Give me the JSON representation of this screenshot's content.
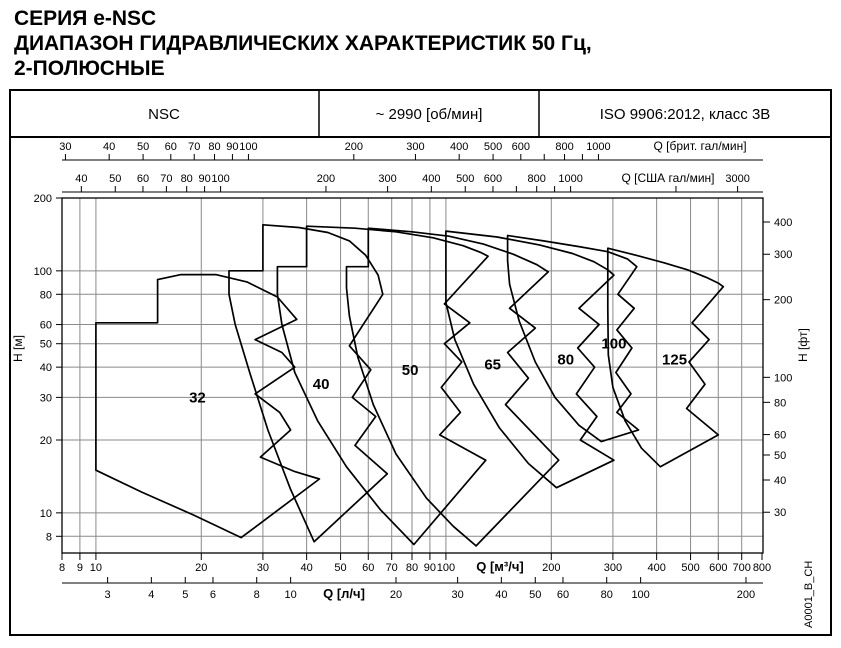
{
  "title": {
    "line1": "СЕРИЯ e-NSC",
    "line2": "ДИАПАЗОН ГИДРАВЛИЧЕСКИХ ХАРАКТЕРИСТИК 50 Гц,",
    "line3": "2-ПОЛЮСНЫЕ"
  },
  "header": {
    "series": "NSC",
    "speed": "~ 2990 [об/мин]",
    "standard": "ISO 9906:2012, класс 3В"
  },
  "side_code": "A0001_B_CH",
  "chart_data": {
    "type": "area",
    "scale": "log-log",
    "x_range_m3h": [
      8,
      800
    ],
    "y_range_m": [
      6.8,
      200
    ],
    "axes": {
      "imp": {
        "label": "Q [брит. гал/мин]",
        "to_m3h": 0.27276,
        "ticks": [
          30,
          40,
          50,
          60,
          70,
          80,
          90,
          100,
          200,
          300,
          400,
          500,
          600,
          700,
          800,
          900,
          1000
        ],
        "unlabeled": [
          700,
          900
        ]
      },
      "us": {
        "label": "Q [США гал/мин]",
        "to_m3h": 0.22712,
        "ticks": [
          40,
          50,
          60,
          70,
          80,
          90,
          100,
          200,
          300,
          400,
          500,
          600,
          700,
          800,
          900,
          1000,
          2000,
          3000
        ],
        "unlabeled": [
          700,
          900,
          2000
        ]
      },
      "m3h": {
        "label": "Q [м³/ч]",
        "ticks": [
          8,
          9,
          10,
          20,
          30,
          40,
          50,
          60,
          70,
          80,
          90,
          100,
          200,
          300,
          400,
          500,
          600,
          700,
          800
        ],
        "unlabeled": []
      },
      "ls": {
        "label": "Q [л/ч]",
        "to_m3h": 3.6,
        "ticks": [
          3,
          4,
          5,
          6,
          8,
          10,
          20,
          30,
          40,
          50,
          60,
          80,
          100,
          200
        ],
        "unlabeled": []
      },
      "m": {
        "label": "H [м]",
        "ticks": [
          200,
          100,
          80,
          60,
          50,
          40,
          30,
          20,
          10,
          8
        ]
      },
      "ft": {
        "label": "H [фт]",
        "ticks": [
          400,
          300,
          200,
          100,
          80,
          60,
          50,
          40,
          30
        ]
      }
    },
    "grid": {
      "q": [
        9,
        10,
        20,
        30,
        40,
        50,
        60,
        70,
        80,
        90,
        100,
        200,
        300,
        400,
        500,
        600,
        700
      ],
      "h": [
        8,
        10,
        20,
        30,
        40,
        50,
        60,
        80,
        100
      ]
    },
    "regions": [
      {
        "name": "32",
        "points": [
          [
            10,
            61
          ],
          [
            15,
            61
          ],
          [
            15,
            92
          ],
          [
            17.5,
            96.5
          ],
          [
            22,
            96.5
          ],
          [
            27,
            90
          ],
          [
            33,
            78
          ],
          [
            37.5,
            63
          ],
          [
            28.5,
            52
          ],
          [
            34,
            46
          ],
          [
            37,
            40
          ],
          [
            28.5,
            31
          ],
          [
            33.5,
            26
          ],
          [
            36,
            22
          ],
          [
            29.5,
            17
          ],
          [
            37,
            14.8
          ],
          [
            43.5,
            13.8
          ],
          [
            26,
            7.9
          ],
          [
            19,
            9.8
          ],
          [
            13.5,
            12.2
          ],
          [
            10,
            15
          ]
        ]
      },
      {
        "name": "40",
        "points": [
          [
            30,
            155
          ],
          [
            38,
            151
          ],
          [
            46,
            144
          ],
          [
            53,
            133
          ],
          [
            59,
            116
          ],
          [
            64,
            96
          ],
          [
            66,
            80
          ],
          [
            53,
            49
          ],
          [
            61,
            39
          ],
          [
            54,
            30
          ],
          [
            63,
            25
          ],
          [
            55,
            19
          ],
          [
            68,
            14.5
          ],
          [
            42,
            7.6
          ],
          [
            36,
            12.5
          ],
          [
            31,
            22
          ],
          [
            27.5,
            38
          ],
          [
            25,
            60
          ],
          [
            24,
            80
          ],
          [
            24,
            91
          ],
          [
            24,
            100
          ],
          [
            30,
            100
          ]
        ]
      },
      {
        "name": "50",
        "points": [
          [
            40,
            153
          ],
          [
            55,
            150
          ],
          [
            72,
            145
          ],
          [
            92,
            137
          ],
          [
            112,
            127
          ],
          [
            126,
            119
          ],
          [
            132,
            115
          ],
          [
            99,
            73
          ],
          [
            117,
            61
          ],
          [
            99,
            50
          ],
          [
            111,
            42
          ],
          [
            97,
            33
          ],
          [
            110,
            26
          ],
          [
            96,
            21
          ],
          [
            130,
            16.5
          ],
          [
            81,
            7.4
          ],
          [
            65,
            10.3
          ],
          [
            52,
            15.5
          ],
          [
            43,
            24
          ],
          [
            37,
            38
          ],
          [
            34,
            60
          ],
          [
            33,
            80
          ],
          [
            33,
            95
          ],
          [
            33,
            104
          ],
          [
            40,
            104
          ]
        ]
      },
      {
        "name": "65",
        "points": [
          [
            60,
            150
          ],
          [
            80,
            145
          ],
          [
            102,
            139
          ],
          [
            128,
            129
          ],
          [
            156,
            117
          ],
          [
            182,
            106
          ],
          [
            196,
            99
          ],
          [
            152,
            70
          ],
          [
            180,
            58
          ],
          [
            150,
            46
          ],
          [
            172,
            36
          ],
          [
            148,
            28
          ],
          [
            210,
            16.5
          ],
          [
            122,
            7.3
          ],
          [
            105,
            8.8
          ],
          [
            88,
            11.5
          ],
          [
            72,
            17.5
          ],
          [
            62,
            28
          ],
          [
            56,
            44
          ],
          [
            53,
            65
          ],
          [
            52,
            85
          ],
          [
            52,
            95
          ],
          [
            52,
            104
          ],
          [
            60,
            104
          ]
        ]
      },
      {
        "name": "80",
        "points": [
          [
            100,
            146
          ],
          [
            140,
            138
          ],
          [
            185,
            128
          ],
          [
            230,
            118
          ],
          [
            265,
            109
          ],
          [
            290,
            101
          ],
          [
            302,
            96
          ],
          [
            240,
            70
          ],
          [
            274,
            60
          ],
          [
            238,
            48
          ],
          [
            266,
            40
          ],
          [
            236,
            31
          ],
          [
            270,
            25
          ],
          [
            242,
            20
          ],
          [
            302,
            16.5
          ],
          [
            207,
            12.7
          ],
          [
            172,
            16
          ],
          [
            142,
            22.5
          ],
          [
            120,
            34
          ],
          [
            106,
            52
          ],
          [
            100,
            74
          ],
          [
            100,
            100
          ]
        ]
      },
      {
        "name": "100",
        "points": [
          [
            150,
            140
          ],
          [
            190,
            133
          ],
          [
            240,
            126
          ],
          [
            290,
            120
          ],
          [
            330,
            112
          ],
          [
            351,
            104
          ],
          [
            310,
            80
          ],
          [
            345,
            70
          ],
          [
            308,
            57
          ],
          [
            340,
            48
          ],
          [
            306,
            38
          ],
          [
            338,
            31
          ],
          [
            308,
            26
          ],
          [
            355,
            22
          ],
          [
            278,
            19.7
          ],
          [
            240,
            23
          ],
          [
            205,
            30
          ],
          [
            180,
            42
          ],
          [
            162,
            62
          ],
          [
            152,
            88
          ],
          [
            150,
            110
          ]
        ]
      },
      {
        "name": "125",
        "points": [
          [
            290,
            124
          ],
          [
            350,
            116
          ],
          [
            420,
            108
          ],
          [
            490,
            101
          ],
          [
            555,
            94
          ],
          [
            600,
            89
          ],
          [
            620,
            86
          ],
          [
            505,
            61
          ],
          [
            565,
            52
          ],
          [
            495,
            42
          ],
          [
            550,
            34
          ],
          [
            487,
            27
          ],
          [
            600,
            21
          ],
          [
            410,
            15.5
          ],
          [
            362,
            18.5
          ],
          [
            325,
            24
          ],
          [
            300,
            33
          ],
          [
            291,
            45
          ],
          [
            290,
            70
          ]
        ]
      }
    ],
    "region_labels": [
      {
        "text": "32",
        "q": 19.5,
        "h": 30
      },
      {
        "text": "40",
        "q": 44,
        "h": 34
      },
      {
        "text": "50",
        "q": 79,
        "h": 39
      },
      {
        "text": "65",
        "q": 136,
        "h": 41
      },
      {
        "text": "80",
        "q": 220,
        "h": 43
      },
      {
        "text": "100",
        "q": 302,
        "h": 50
      },
      {
        "text": "125",
        "q": 450,
        "h": 43
      }
    ]
  }
}
